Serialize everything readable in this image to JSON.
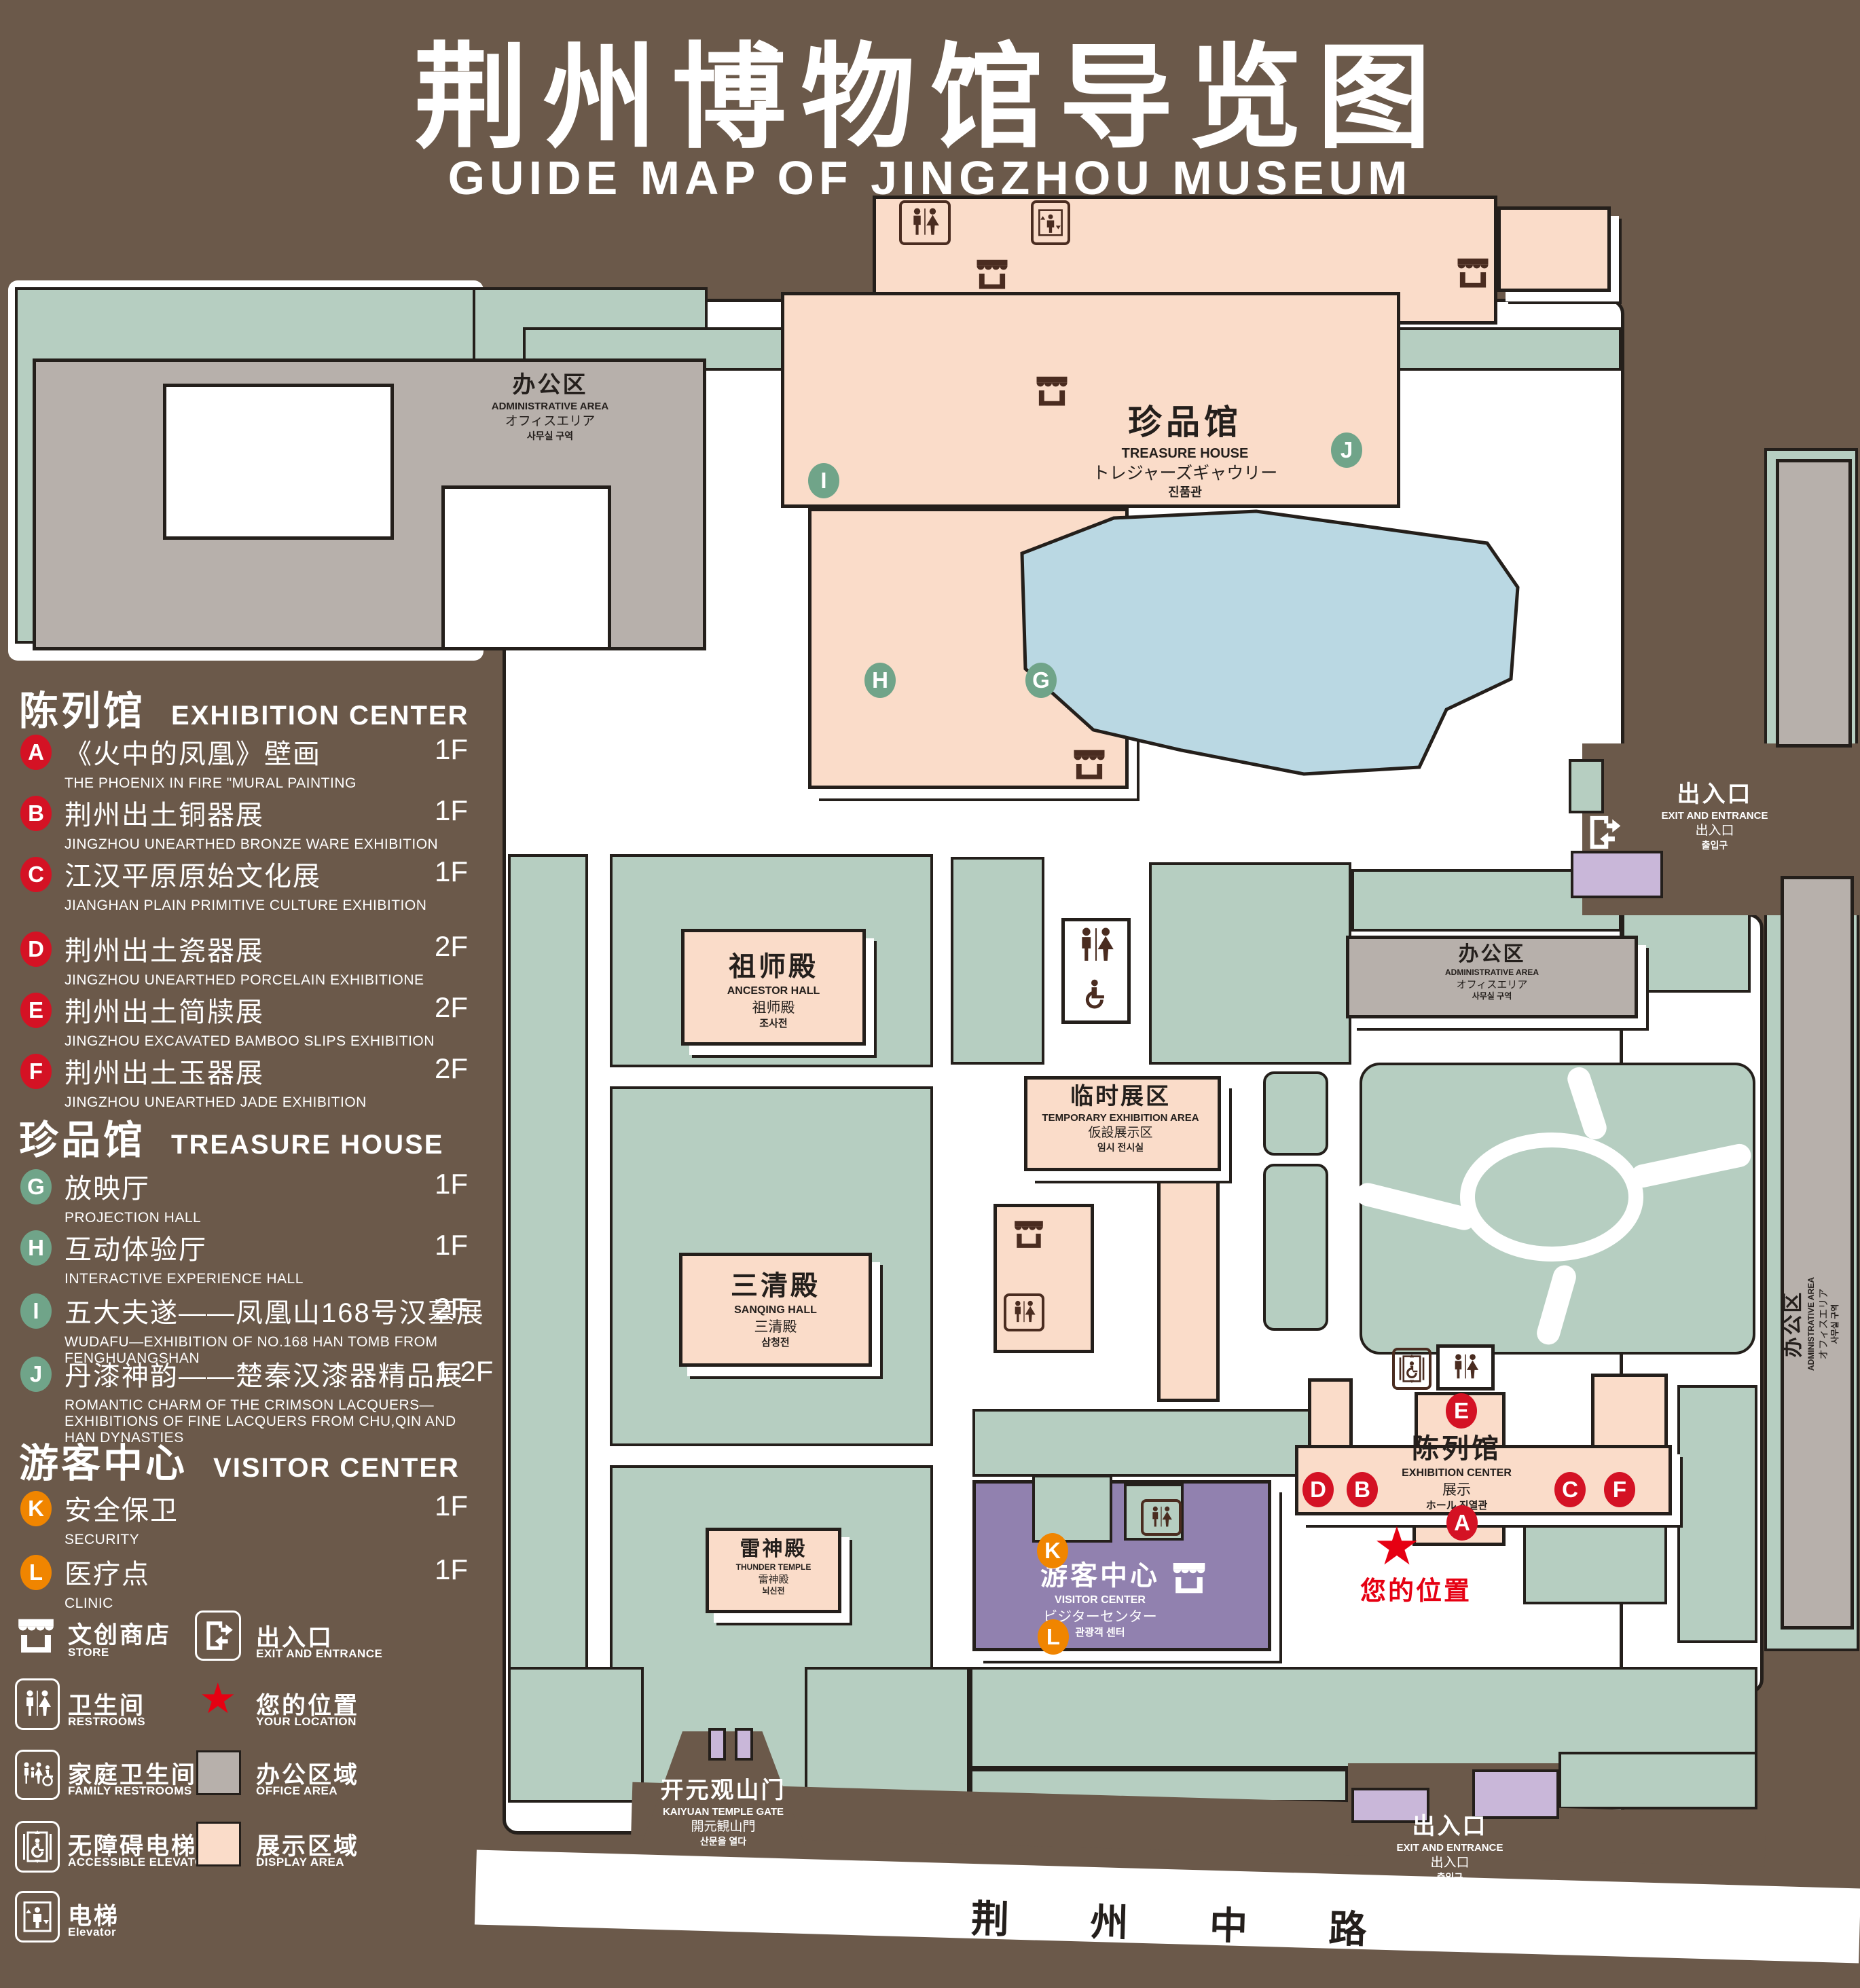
{
  "title": {
    "zh": "荆州博物馆导览图",
    "en": "GUIDE MAP OF JINGZHOU MUSEUM"
  },
  "colors": {
    "background": "#6b594a",
    "lawn_green": "#b6cec1",
    "office_gray": "#b7b0ab",
    "display_pink": "#fadcc9",
    "water_blue": "#bad8e3",
    "visitor_purple": "#9181af",
    "small_building_purple": "#c9b7d9",
    "badge_red": "#d41224",
    "badge_green": "#70a489",
    "badge_orange": "#f08500",
    "location_red": "#e60012"
  },
  "legend": {
    "sections": [
      {
        "zh": "陈列馆",
        "en": "EXHIBITION CENTER",
        "items": [
          {
            "key": "A",
            "zh": "《火中的凤凰》壁画",
            "en": "THE PHOENIX IN FIRE \"MURAL PAINTING",
            "floor": "1F"
          },
          {
            "key": "B",
            "zh": "荆州出土铜器展",
            "en": "JINGZHOU UNEARTHED BRONZE WARE EXHIBITION",
            "floor": "1F"
          },
          {
            "key": "C",
            "zh": "江汉平原原始文化展",
            "en": "JIANGHAN PLAIN PRIMITIVE CULTURE EXHIBITION",
            "floor": "1F"
          },
          {
            "key": "D",
            "zh": "荆州出土瓷器展",
            "en": "JINGZHOU UNEARTHED PORCELAIN EXHIBITIONE",
            "floor": "2F"
          },
          {
            "key": "E",
            "zh": "荆州出土简牍展",
            "en": "JINGZHOU EXCAVATED BAMBOO SLIPS EXHIBITION",
            "floor": "2F"
          },
          {
            "key": "F",
            "zh": "荆州出土玉器展",
            "en": "JINGZHOU UNEARTHED JADE EXHIBITION",
            "floor": "2F"
          }
        ]
      },
      {
        "zh": "珍品馆",
        "en": "TREASURE HOUSE",
        "items": [
          {
            "key": "G",
            "zh": "放映厅",
            "en": "PROJECTION HALL",
            "floor": "1F"
          },
          {
            "key": "H",
            "zh": "互动体验厅",
            "en": "INTERACTIVE EXPERIENCE HALL",
            "floor": "1F"
          },
          {
            "key": "I",
            "zh": "五大夫遂——凤凰山168号汉墓展",
            "en": "WUDAFU—EXHIBITION OF NO.168 HAN TOMB FROM FENGHUANGSHAN",
            "floor": "2F"
          },
          {
            "key": "J",
            "zh": "丹漆神韵——楚秦汉漆器精品展",
            "en": "ROMANTIC CHARM OF THE CRIMSON LACQUERS—EXHIBITIONS OF FINE LACQUERS FROM CHU,QIN AND HAN DYNASTIES",
            "floor": "1-2F"
          }
        ]
      },
      {
        "zh": "游客中心",
        "en": "VISITOR CENTER",
        "items": [
          {
            "key": "K",
            "zh": "安全保卫",
            "en": "SECURITY",
            "floor": "1F"
          },
          {
            "key": "L",
            "zh": "医疗点",
            "en": "CLINIC",
            "floor": "1F"
          }
        ]
      }
    ],
    "symbols": [
      {
        "icon": "store-icon",
        "zh": "文创商店",
        "en": "STORE"
      },
      {
        "icon": "exit-icon",
        "zh": "出入口",
        "en": "EXIT AND ENTRANCE"
      },
      {
        "icon": "restroom-icon",
        "zh": "卫生间",
        "en": "RESTROOMS"
      },
      {
        "icon": "location-star-icon",
        "zh": "您的位置",
        "en": "YOUR LOCATION"
      },
      {
        "icon": "family-restroom-icon",
        "zh": "家庭卫生间",
        "en": "FAMILY RESTROOMS"
      },
      {
        "icon": "office-area-swatch",
        "zh": "办公区域",
        "en": "OFFICE AREA"
      },
      {
        "icon": "accessible-elevator-icon",
        "zh": "无障碍电梯",
        "en": "ACCESSIBLE ELEVATOR"
      },
      {
        "icon": "display-area-swatch",
        "zh": "展示区域",
        "en": "DISPLAY AREA"
      },
      {
        "icon": "elevator-icon",
        "zh": "电梯",
        "en": "Elevator"
      }
    ]
  },
  "map": {
    "buildings": {
      "admin": {
        "l1": "办公区",
        "l2": "ADMINISTRATIVE AREA",
        "l3": "オフィスエリア",
        "l4": "사무실 구역"
      },
      "treasure_house": {
        "l1": "珍品馆",
        "l2": "TREASURE HOUSE",
        "l3": "トレジャーズギャウリー",
        "l4": "진품관"
      },
      "ancestor_hall": {
        "l1": "祖师殿",
        "l2": "ANCESTOR HALL",
        "l3": "祖师殿",
        "l4": "조사전"
      },
      "temporary_exhibition": {
        "l1": "临时展区",
        "l2": "TEMPORARY EXHIBITION AREA",
        "l3": "仮設展示区",
        "l4": "임시 전시실"
      },
      "sanqing_hall": {
        "l1": "三清殿",
        "l2": "SANQING HALL",
        "l3": "三清殿",
        "l4": "삼청전"
      },
      "thunder_temple": {
        "l1": "雷神殿",
        "l2": "THUNDER TEMPLE",
        "l3": "雷神殿",
        "l4": "뇌신전"
      },
      "visitor_center": {
        "l1": "游客中心",
        "l2": "VISITOR CENTER",
        "l3": "ビジターセンター",
        "l4": "관광객 센터"
      },
      "exhibition_center": {
        "l1": "陈列馆",
        "l2": "EXHIBITION CENTER",
        "l3": "展示",
        "l4": "ホール 진열관"
      }
    },
    "exit": {
      "l1": "出入口",
      "l2": "EXIT AND ENTRANCE",
      "l3": "出入口",
      "l4": "출입구"
    },
    "gate": {
      "l1": "开元观山门",
      "l2": "KAIYUAN TEMPLE GATE",
      "l3": "開元観山門",
      "l4": "산문을 열다"
    },
    "road": "荆 州 中 路",
    "your_location": "您的位置"
  }
}
